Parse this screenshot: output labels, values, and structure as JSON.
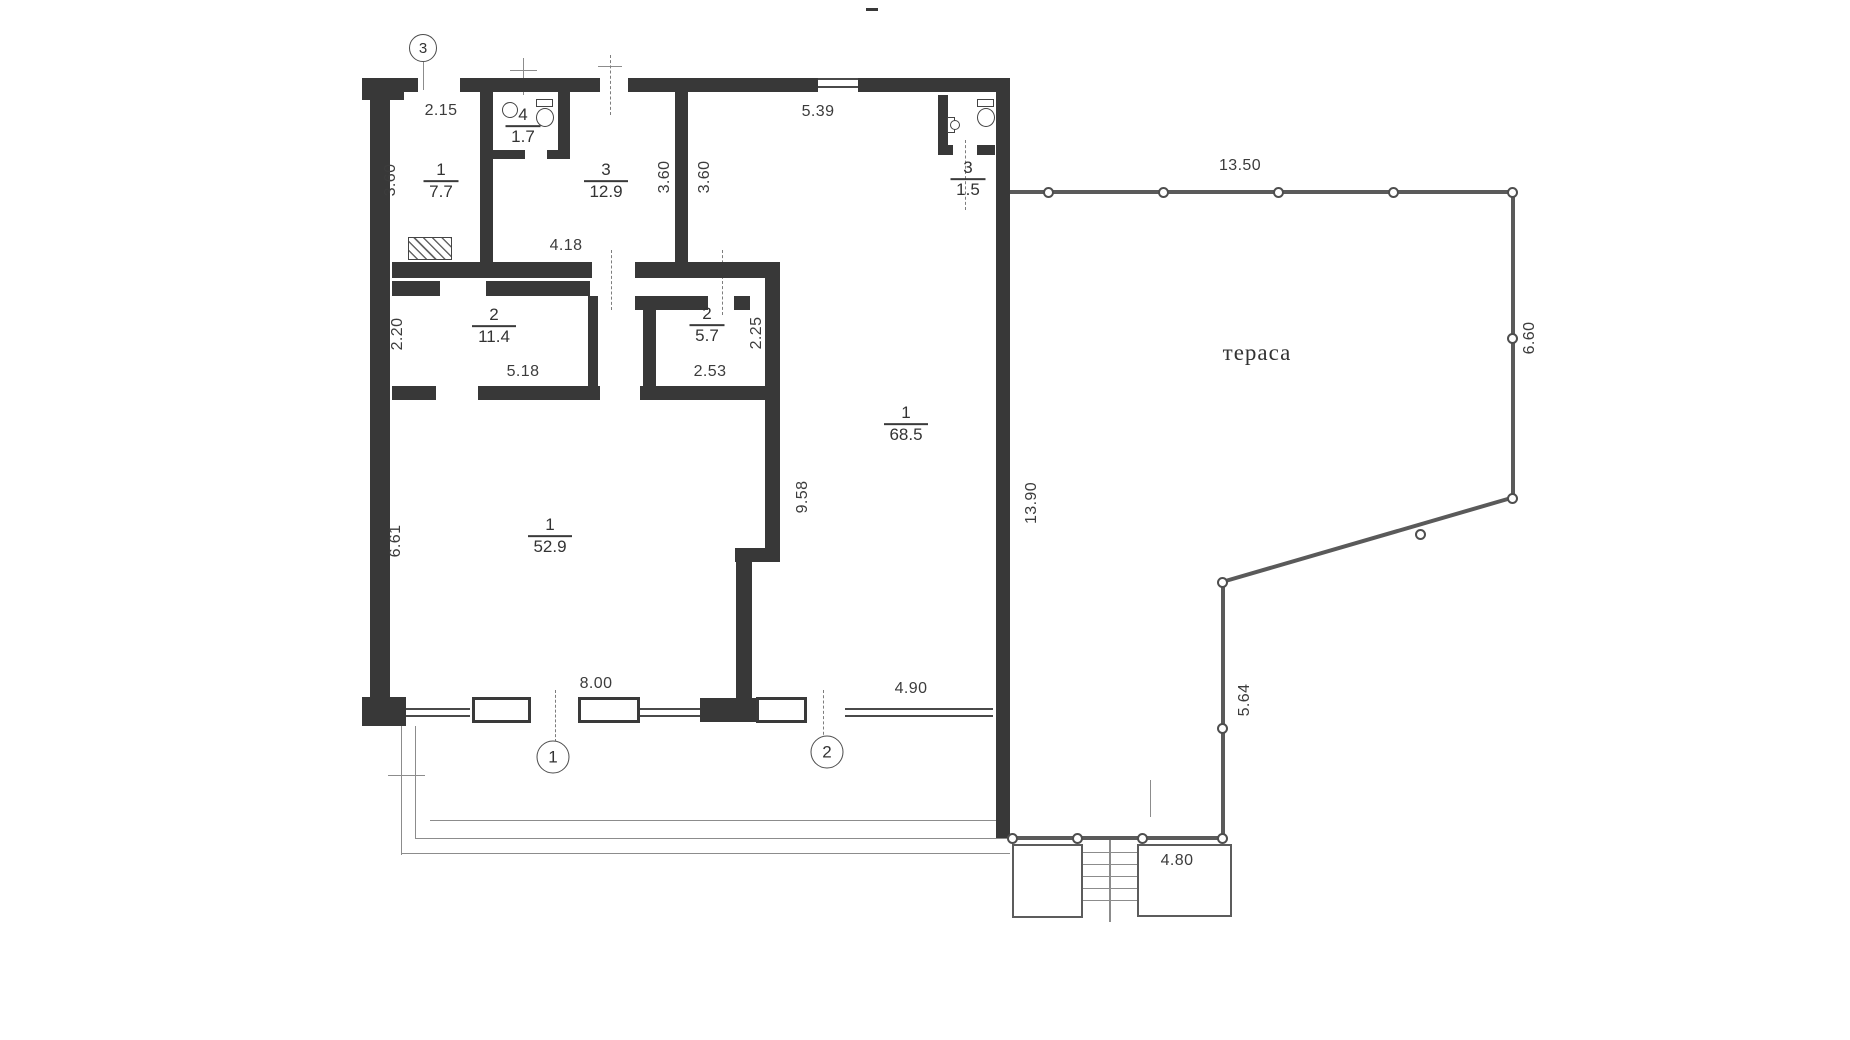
{
  "title": "Scanned apartment floor plan with terrace",
  "terrace": {
    "label": "тераса"
  },
  "colors": {
    "wall": "#383838",
    "rail": "#5a5a5a",
    "thin_line": "#8c8c8c",
    "text": "#3c3c3c",
    "background": "#ffffff"
  },
  "plan": {
    "rooms": [
      {
        "number": "1",
        "area": "7.7",
        "x": 441,
        "y": 181
      },
      {
        "number": "4",
        "area": "1.7",
        "x": 523,
        "y": 126
      },
      {
        "number": "3",
        "area": "12.9",
        "x": 606,
        "y": 181
      },
      {
        "number": "3",
        "area": "1.5",
        "x": 968,
        "y": 179
      },
      {
        "number": "2",
        "area": "11.4",
        "x": 494,
        "y": 326
      },
      {
        "number": "2",
        "area": "5.7",
        "x": 707,
        "y": 325
      },
      {
        "number": "1",
        "area": "52.9",
        "x": 550,
        "y": 536
      },
      {
        "number": "1",
        "area": "68.5",
        "x": 906,
        "y": 424
      }
    ],
    "dimensions": [
      {
        "text": "2.15",
        "x": 441,
        "y": 111,
        "rot": false
      },
      {
        "text": "5.39",
        "x": 818,
        "y": 112,
        "rot": false
      },
      {
        "text": "13.50",
        "x": 1240,
        "y": 166,
        "rot": false
      },
      {
        "text": "4.18",
        "x": 566,
        "y": 246,
        "rot": false
      },
      {
        "text": "5.18",
        "x": 523,
        "y": 372,
        "rot": false
      },
      {
        "text": "2.53",
        "x": 710,
        "y": 372,
        "rot": false
      },
      {
        "text": "8.00",
        "x": 596,
        "y": 684,
        "rot": false
      },
      {
        "text": "4.90",
        "x": 911,
        "y": 689,
        "rot": false
      },
      {
        "text": "4.80",
        "x": 1177,
        "y": 861,
        "rot": false
      },
      {
        "text": "3.60",
        "x": 391,
        "y": 180,
        "rot": true
      },
      {
        "text": "3.60",
        "x": 665,
        "y": 177,
        "rot": true
      },
      {
        "text": "3.60",
        "x": 705,
        "y": 177,
        "rot": true
      },
      {
        "text": "2.20",
        "x": 398,
        "y": 334,
        "rot": true
      },
      {
        "text": "2.25",
        "x": 757,
        "y": 333,
        "rot": true
      },
      {
        "text": "6.61",
        "x": 396,
        "y": 541,
        "rot": true
      },
      {
        "text": "9.58",
        "x": 803,
        "y": 497,
        "rot": true
      },
      {
        "text": "13.90",
        "x": 1032,
        "y": 503,
        "rot": true
      },
      {
        "text": "6.60",
        "x": 1530,
        "y": 338,
        "rot": true
      },
      {
        "text": "5.64",
        "x": 1245,
        "y": 700,
        "rot": true
      }
    ],
    "axis_markers": [
      {
        "text": "3",
        "x": 423,
        "y": 48,
        "d": 28
      },
      {
        "text": "1",
        "x": 553,
        "y": 757,
        "d": 33
      },
      {
        "text": "2",
        "x": 827,
        "y": 752,
        "d": 33
      }
    ],
    "walls": [
      [
        362,
        78,
        42,
        22
      ],
      [
        404,
        78,
        14,
        14
      ],
      [
        460,
        78,
        140,
        14
      ],
      [
        628,
        78,
        190,
        14
      ],
      [
        858,
        78,
        152,
        14
      ],
      [
        370,
        92,
        20,
        616
      ],
      [
        362,
        697,
        44,
        29
      ],
      [
        996,
        78,
        14,
        760
      ],
      [
        700,
        698,
        56,
        24
      ],
      [
        480,
        92,
        13,
        170
      ],
      [
        558,
        92,
        12,
        66
      ],
      [
        493,
        150,
        32,
        9
      ],
      [
        547,
        150,
        23,
        9
      ],
      [
        392,
        262,
        200,
        16
      ],
      [
        635,
        262,
        145,
        16
      ],
      [
        675,
        92,
        13,
        170
      ],
      [
        392,
        281,
        48,
        15
      ],
      [
        486,
        281,
        104,
        15
      ],
      [
        588,
        296,
        10,
        90
      ],
      [
        635,
        296,
        73,
        14
      ],
      [
        734,
        296,
        16,
        14
      ],
      [
        643,
        310,
        13,
        76
      ],
      [
        765,
        278,
        15,
        120
      ],
      [
        392,
        386,
        44,
        14
      ],
      [
        478,
        386,
        122,
        14
      ],
      [
        640,
        386,
        140,
        14
      ],
      [
        765,
        398,
        15,
        160
      ],
      [
        735,
        548,
        45,
        14
      ],
      [
        736,
        558,
        16,
        140
      ],
      [
        938,
        95,
        10,
        60
      ],
      [
        938,
        145,
        15,
        10
      ],
      [
        977,
        145,
        18,
        10
      ],
      [
        866,
        8,
        12,
        3
      ]
    ],
    "sills": [
      [
        406,
        708,
        64,
        9
      ],
      [
        640,
        708,
        60,
        9
      ],
      [
        845,
        708,
        148,
        9
      ],
      [
        818,
        78,
        40,
        10
      ]
    ],
    "windows": [
      [
        472,
        697,
        59,
        26
      ],
      [
        578,
        697,
        62,
        26
      ],
      [
        756,
        697,
        51,
        26
      ]
    ],
    "outline_rects": [
      [
        1012,
        844,
        71,
        74
      ],
      [
        1137,
        844,
        95,
        73
      ]
    ],
    "thin_lines": [
      [
        401,
        726,
        1,
        129
      ],
      [
        415,
        726,
        1,
        112
      ],
      [
        430,
        820,
        566,
        1
      ],
      [
        415,
        838,
        595,
        1
      ],
      [
        401,
        853,
        609,
        1
      ],
      [
        388,
        775,
        37,
        1
      ],
      [
        598,
        66,
        24,
        1
      ],
      [
        510,
        70,
        27,
        1
      ],
      [
        523,
        58,
        1,
        37
      ],
      [
        423,
        62,
        1,
        28
      ],
      [
        1109,
        840,
        2,
        82
      ],
      [
        1083,
        852,
        54,
        1
      ],
      [
        1083,
        864,
        54,
        1
      ],
      [
        1083,
        876,
        54,
        1
      ],
      [
        1083,
        888,
        54,
        1
      ],
      [
        1083,
        900,
        54,
        1
      ],
      [
        1150,
        780,
        1,
        37
      ]
    ],
    "dashed_lines": [
      [
        610,
        55,
        1,
        60
      ],
      [
        611,
        250,
        1,
        60
      ],
      [
        722,
        250,
        1,
        65
      ],
      [
        555,
        690,
        1,
        52
      ],
      [
        823,
        690,
        1,
        50
      ],
      [
        965,
        140,
        1,
        70
      ]
    ],
    "railings": [
      {
        "x": 1010,
        "y": 190,
        "len": 502,
        "ang": 0
      },
      {
        "x": 1513,
        "y": 190,
        "len": 308,
        "ang": 90
      },
      {
        "x": 1222,
        "y": 580,
        "len": 302,
        "ang": -16.2
      },
      {
        "x": 1223,
        "y": 582,
        "len": 256,
        "ang": 90
      },
      {
        "x": 1010,
        "y": 836,
        "len": 212,
        "ang": 0
      }
    ],
    "posts": [
      [
        1048,
        192
      ],
      [
        1163,
        192
      ],
      [
        1278,
        192
      ],
      [
        1393,
        192
      ],
      [
        1512,
        192
      ],
      [
        1512,
        338
      ],
      [
        1512,
        498
      ],
      [
        1420,
        534
      ],
      [
        1222,
        582
      ],
      [
        1222,
        728
      ],
      [
        1222,
        838
      ],
      [
        1142,
        838
      ],
      [
        1077,
        838
      ],
      [
        1012,
        838
      ]
    ],
    "fixtures": [
      {
        "type": "toilet-down",
        "x": 536,
        "y": 99
      },
      {
        "type": "sink-corner",
        "x": 502,
        "y": 102
      },
      {
        "type": "toilet-down",
        "x": 977,
        "y": 99
      },
      {
        "type": "sink-wall",
        "x": 947,
        "y": 117
      },
      {
        "type": "stove",
        "x": 408,
        "y": 237
      }
    ]
  }
}
